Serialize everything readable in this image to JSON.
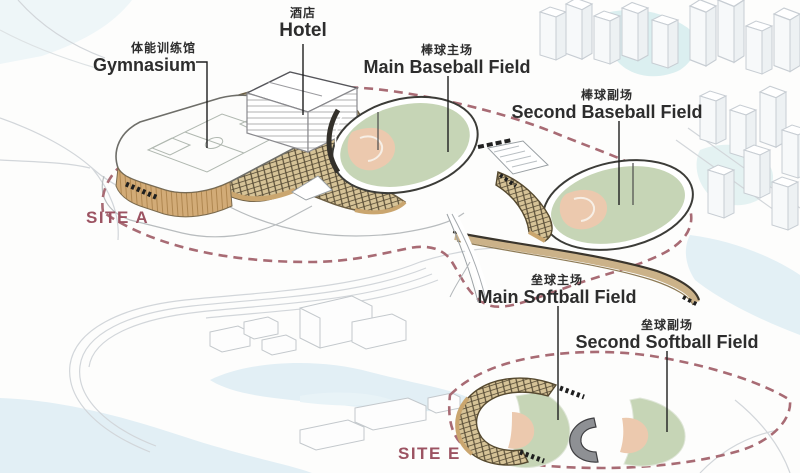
{
  "diagram_title": "Sports park axonometric site plan",
  "labels": {
    "gymnasium": {
      "zh": "体能训练馆",
      "en": "Gymnasium"
    },
    "hotel": {
      "zh": "酒店",
      "en": "Hotel"
    },
    "main_baseball": {
      "zh": "棒球主场",
      "en": "Main Baseball Field"
    },
    "second_baseball": {
      "zh": "棒球副场",
      "en": "Second Baseball Field"
    },
    "main_softball": {
      "zh": "垒球主场",
      "en": "Main Softball Field"
    },
    "second_softball": {
      "zh": "垒球副场",
      "en": "Second Softball Field"
    }
  },
  "sites": {
    "site_a": "SITE A",
    "site_e": "SITE E"
  },
  "colors": {
    "site_boundary": "#a86b74",
    "site_text": "#9c5362",
    "field_green": "#c6d5b6",
    "infield_tan": "#ecc9ae",
    "canopy_wood": "#d6c397",
    "canopy_line": "#564b35",
    "water_blue": "#e2eff5",
    "water_teal": "#dbeff0",
    "label_text": "#2d2d2d"
  }
}
